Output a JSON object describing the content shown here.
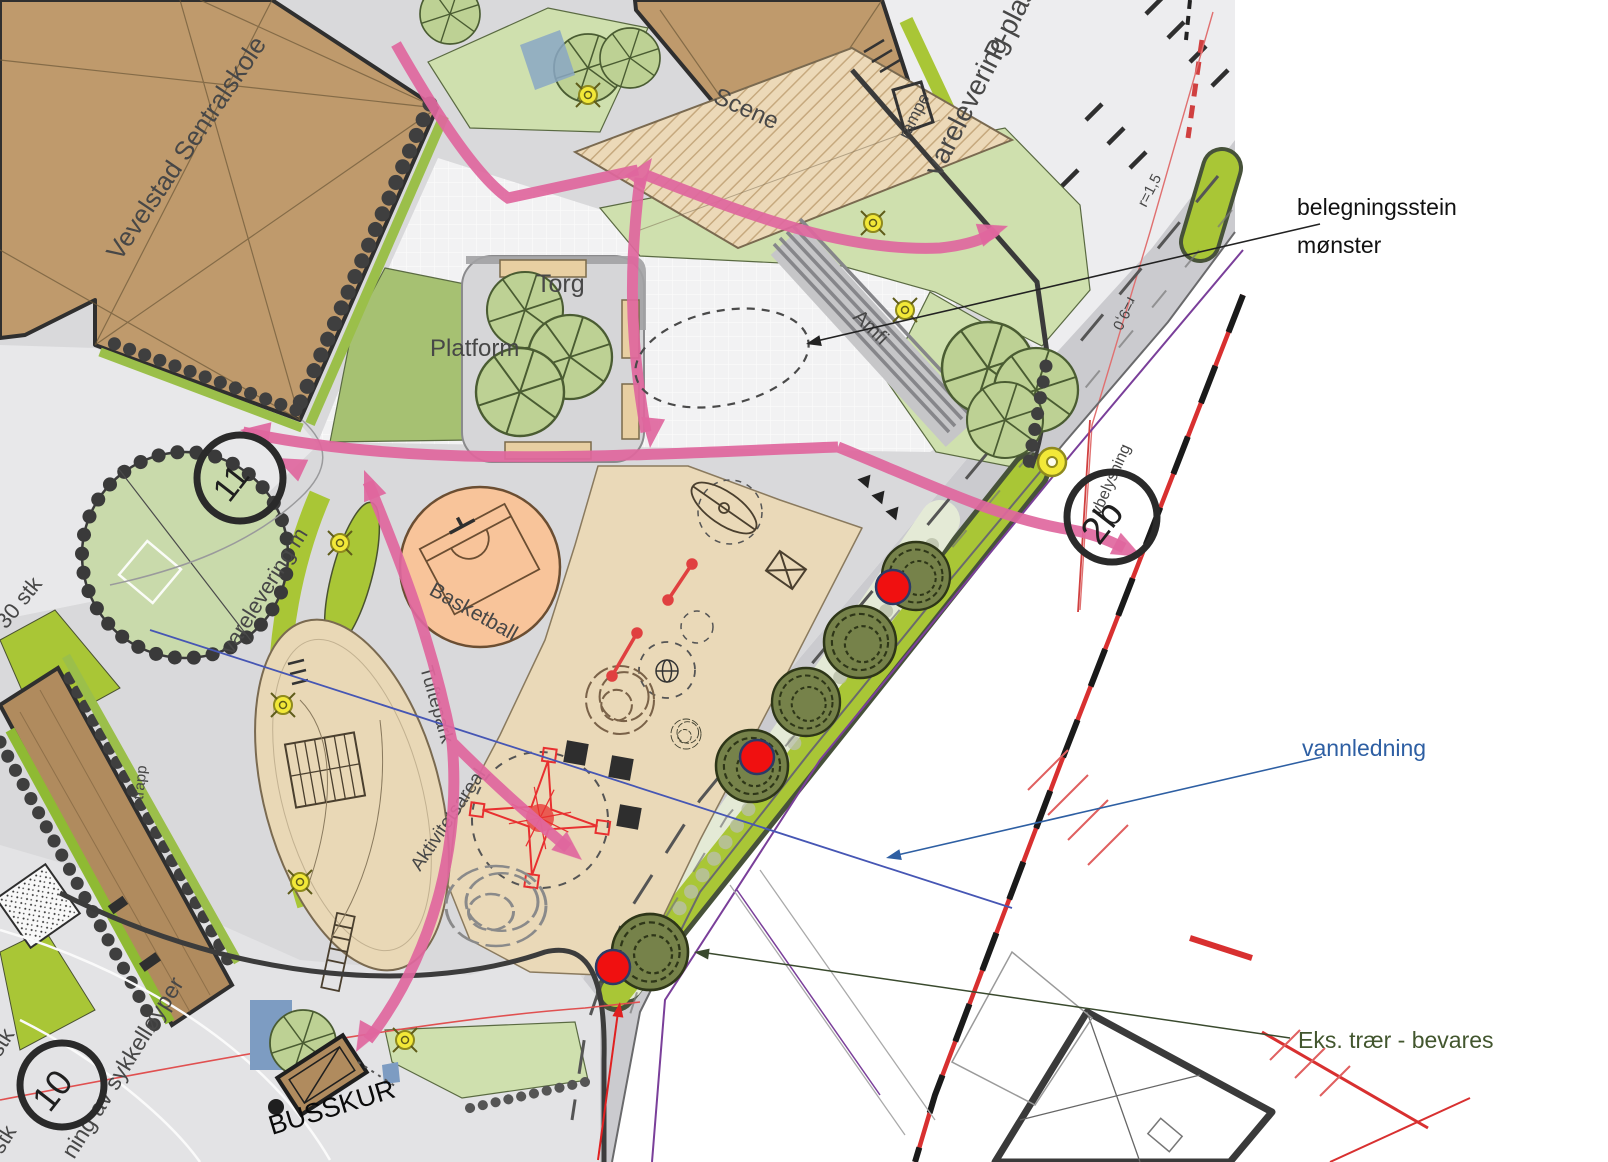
{
  "plan": {
    "labels": {
      "school": "Vevelstad Sentralskole",
      "scene": "Scene",
      "torg": "Torg",
      "platform": "Platform",
      "amfi": "Amfi",
      "basketball": "Basketball",
      "tuftepark": "Tuftepark",
      "aktivitetsareal": "Aktivitetsareal",
      "varelevering_m": "varelevering m",
      "varelevering": "varelevering",
      "p_plass": "P-plass",
      "rampe": "rampe",
      "r15": "r=1,5",
      "r90": "r=9,0",
      "belysning": "vbelysning",
      "stk30": "30 stk",
      "stk_upper": "stk",
      "stk_lower": "stk",
      "sykkelloyper": "ning av sykkelløyper",
      "busskur": "BUSSKUR",
      "trapp": "trapp",
      "num_2b": "2b",
      "num_11": "11",
      "num_10": "10"
    },
    "annotations": {
      "paving_line1": "belegningsstein",
      "paving_line2": "mønster",
      "water": "vannledning",
      "trees": "Eks. trær - bevares"
    },
    "legend_colors": {
      "path_arrows": "#e0679e",
      "buildings": "#bf9a6c",
      "play_surface": "#ead9b8",
      "ball_court": "#f8c49a",
      "lawn": "#cfe0ae",
      "planting_strip": "#a9c636",
      "tree_marker_red": "#ee1111",
      "water_annotation_blue": "#2e5fa3",
      "tree_annotation_green": "#42562e"
    }
  }
}
